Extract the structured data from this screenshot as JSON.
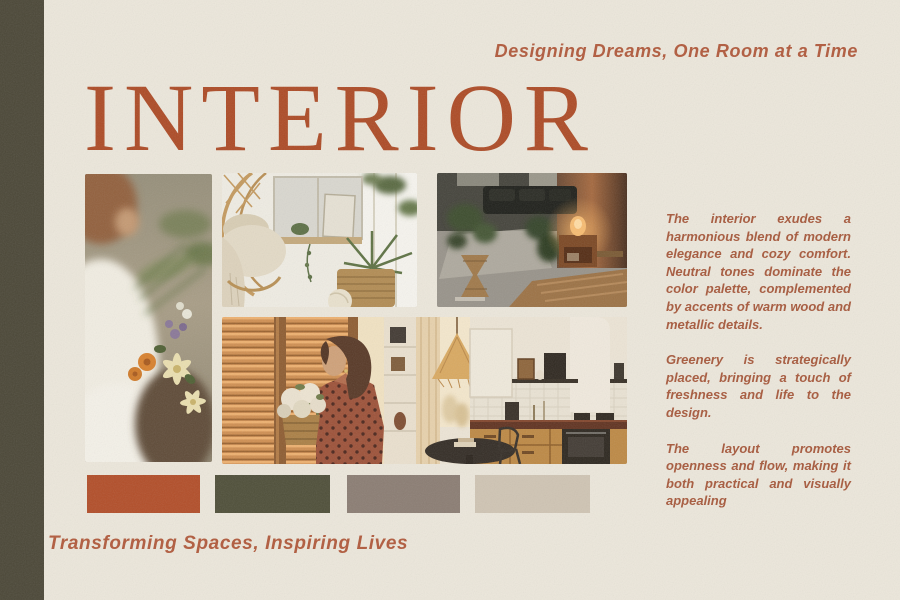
{
  "document": {
    "type": "interior-design-moodboard-poster"
  },
  "colors": {
    "background": "#ece7db",
    "side_stripe": "#4b4737",
    "accent_terracotta": "#ad4b26",
    "body_text": "#a7593c"
  },
  "header": {
    "tagline": "Designing Dreams, One Room at a Time",
    "title": "INTERIOR"
  },
  "gallery": {
    "images": [
      {
        "name": "florist-bouquet",
        "label": "Florist in a white blouse arranging a bouquet of orange and cream flowers"
      },
      {
        "name": "boho-living-room",
        "label": "Bright boho living room with rattan hanging chair, plants and wicker basket"
      },
      {
        "name": "moody-lounge",
        "label": "Moody lounge with dark sofa, plants and a glowing lamp on a wooden side table"
      },
      {
        "name": "sunlit-kitchen",
        "label": "Woman holding white flowers by a sunlit blinded window beside a warm wooden kitchen"
      }
    ]
  },
  "description": {
    "paragraphs": [
      "The interior exudes a harmonious blend of modern elegance and cozy comfort. Neutral tones dominate the color palette, complemented by accents of warm wood and metallic details.",
      "Greenery is strategically placed, bringing a touch of freshness and life to the design.",
      "The layout promotes openness and flow, making it both practical and visually appealing"
    ]
  },
  "palette": {
    "swatches": [
      {
        "name": "terracotta",
        "hex": "#b24e29"
      },
      {
        "name": "dark-olive",
        "hex": "#4f4f39"
      },
      {
        "name": "taupe-grey",
        "hex": "#8b7d73"
      },
      {
        "name": "warm-beige",
        "hex": "#cfc4b3"
      }
    ]
  },
  "footer": {
    "tagline": "Transforming Spaces, Inspiring Lives"
  }
}
